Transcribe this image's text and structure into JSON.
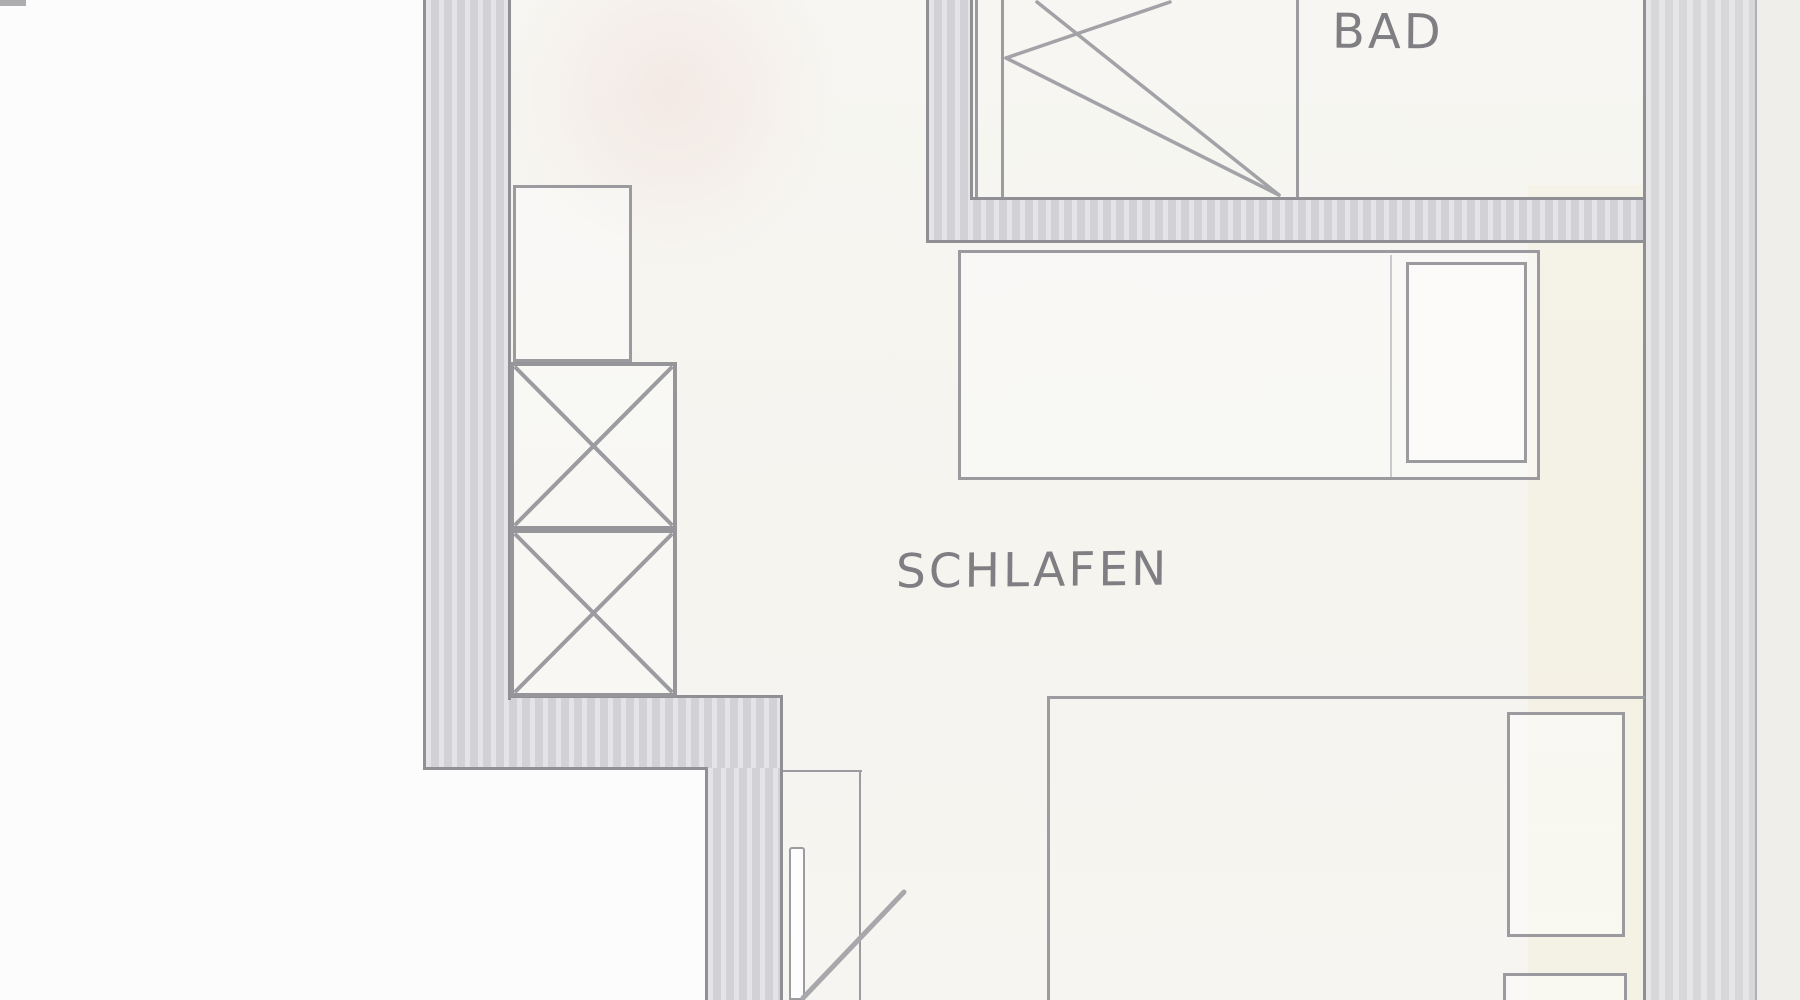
{
  "meta": {
    "document_type": "hand-drawn floor plan (scanned pencil sketch)",
    "view": "partial apartment plan, cropped at top and bottom"
  },
  "labels": {
    "bathroom": "BAD",
    "bedroom": "SCHLAFEN"
  },
  "rooms": [
    {
      "name": "bathroom",
      "label": "BAD",
      "features": [
        "bathtub with diagonal fold lines",
        "left wall",
        "bottom wall"
      ]
    },
    {
      "name": "bedroom",
      "label": "SCHLAFEN",
      "features": [
        "upper bed with pillow and nightstand line",
        "lower bed with two pillows against right wall",
        "wardrobe drawn as two crossed boxes",
        "open shelf rectangle",
        "door leaf with swing line at bottom"
      ]
    }
  ],
  "colors": {
    "paper": "#f6f5f1",
    "paper_outside": "#fcfcfc",
    "wall_fill": "#d8d8db",
    "wall_edge": "#8f8f94",
    "line": "#9b9ba0",
    "text": "#7e7e83"
  }
}
